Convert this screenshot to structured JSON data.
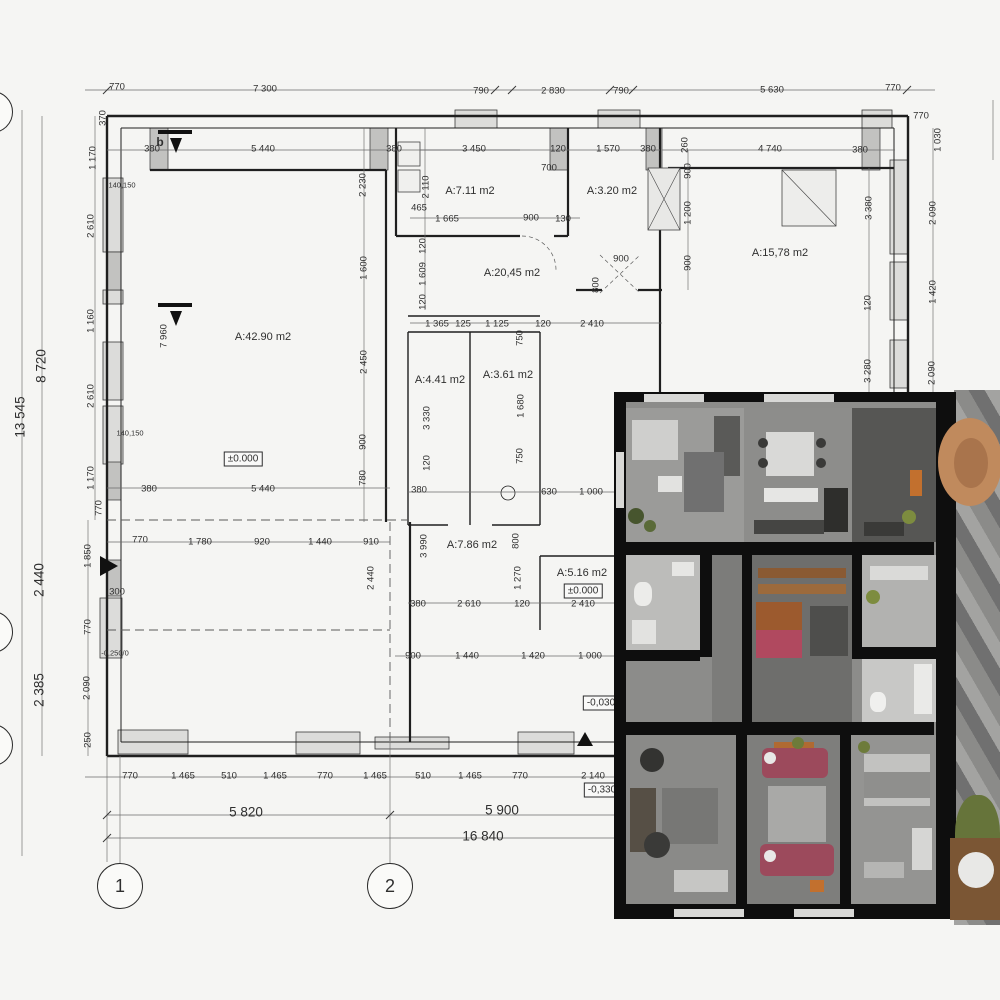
{
  "plan": {
    "section_label": "b",
    "room_labels": [
      {
        "t": "A:7.11 m2",
        "x": 470,
        "y": 191
      },
      {
        "t": "A:3.20 m2",
        "x": 612,
        "y": 191
      },
      {
        "t": "A:15,78 m2",
        "x": 780,
        "y": 253
      },
      {
        "t": "A:20,45 m2",
        "x": 512,
        "y": 273
      },
      {
        "t": "A:42.90 m2",
        "x": 263,
        "y": 337
      },
      {
        "t": "A:4.41 m2",
        "x": 440,
        "y": 380
      },
      {
        "t": "A:3.61 m2",
        "x": 508,
        "y": 375
      },
      {
        "t": "A:7.86 m2",
        "x": 472,
        "y": 545
      },
      {
        "t": "A:5.16 m2",
        "x": 582,
        "y": 573
      }
    ],
    "level_labels": [
      {
        "t": "±0.000",
        "x": 243,
        "y": 459
      },
      {
        "t": "±0.000",
        "x": 583,
        "y": 591
      },
      {
        "t": "-0,030",
        "x": 601,
        "y": 703
      },
      {
        "t": "-0,330",
        "x": 602,
        "y": 790
      }
    ],
    "small_labels": [
      {
        "t": "-0,250/0",
        "x": 115,
        "y": 653
      },
      {
        "t": "140,150",
        "x": 130,
        "y": 433
      },
      {
        "t": "140,150",
        "x": 122,
        "y": 185
      }
    ],
    "axis_bubbles": [
      {
        "n": "1",
        "x": 120,
        "y": 886
      },
      {
        "n": "2",
        "x": 390,
        "y": 886
      }
    ],
    "edge_bubbles": [
      {
        "x": -8,
        "y": 112
      },
      {
        "x": -8,
        "y": 632
      },
      {
        "x": -8,
        "y": 745
      }
    ],
    "dim_labels": [
      {
        "t": "770",
        "x": 117,
        "y": 87
      },
      {
        "t": "7 300",
        "x": 265,
        "y": 89
      },
      {
        "t": "790",
        "x": 481,
        "y": 91
      },
      {
        "t": "2 830",
        "x": 553,
        "y": 91
      },
      {
        "t": "790",
        "x": 621,
        "y": 91
      },
      {
        "t": "5 630",
        "x": 772,
        "y": 90
      },
      {
        "t": "770",
        "x": 893,
        "y": 88
      },
      {
        "t": "770",
        "x": 921,
        "y": 116
      },
      {
        "t": "1 030",
        "x": 938,
        "y": 140,
        "r": 90
      },
      {
        "t": "370",
        "x": 103,
        "y": 118,
        "r": 90
      },
      {
        "t": "380",
        "x": 152,
        "y": 149
      },
      {
        "t": "5 440",
        "x": 263,
        "y": 149
      },
      {
        "t": "380",
        "x": 394,
        "y": 149
      },
      {
        "t": "3 450",
        "x": 474,
        "y": 149
      },
      {
        "t": "120",
        "x": 558,
        "y": 149
      },
      {
        "t": "1 570",
        "x": 608,
        "y": 149
      },
      {
        "t": "380",
        "x": 648,
        "y": 149
      },
      {
        "t": "700",
        "x": 549,
        "y": 168
      },
      {
        "t": "260",
        "x": 685,
        "y": 145,
        "r": 90
      },
      {
        "t": "4 740",
        "x": 770,
        "y": 149
      },
      {
        "t": "380",
        "x": 860,
        "y": 150
      },
      {
        "t": "1 170",
        "x": 93,
        "y": 158,
        "r": 90
      },
      {
        "t": "2 610",
        "x": 91,
        "y": 226,
        "r": 90
      },
      {
        "t": "1 160",
        "x": 91,
        "y": 321,
        "r": 90
      },
      {
        "t": "2 610",
        "x": 91,
        "y": 396,
        "r": 90
      },
      {
        "t": "1 170",
        "x": 91,
        "y": 478,
        "r": 90
      },
      {
        "t": "770",
        "x": 99,
        "y": 508,
        "r": 90
      },
      {
        "t": "13 545",
        "x": 20,
        "y": 417,
        "r": 90,
        "big": 1
      },
      {
        "t": "8 720",
        "x": 41,
        "y": 366,
        "r": 90,
        "big": 1
      },
      {
        "t": "2 440",
        "x": 39,
        "y": 580,
        "r": 90,
        "big": 1
      },
      {
        "t": "2 385",
        "x": 39,
        "y": 690,
        "r": 90,
        "big": 1
      },
      {
        "t": "1 850",
        "x": 88,
        "y": 556,
        "r": 90
      },
      {
        "t": "770",
        "x": 88,
        "y": 627,
        "r": 90
      },
      {
        "t": "2 090",
        "x": 87,
        "y": 688,
        "r": 90
      },
      {
        "t": "250",
        "x": 88,
        "y": 740,
        "r": 90
      },
      {
        "t": "300",
        "x": 117,
        "y": 592
      },
      {
        "t": "770",
        "x": 140,
        "y": 540
      },
      {
        "t": "7 960",
        "x": 164,
        "y": 336,
        "r": 90
      },
      {
        "t": "2 230",
        "x": 363,
        "y": 185,
        "r": 90
      },
      {
        "t": "1 600",
        "x": 364,
        "y": 268,
        "r": 90
      },
      {
        "t": "2 450",
        "x": 364,
        "y": 362,
        "r": 90
      },
      {
        "t": "900",
        "x": 363,
        "y": 442,
        "r": 90
      },
      {
        "t": "780",
        "x": 363,
        "y": 478,
        "r": 90
      },
      {
        "t": "2 110",
        "x": 426,
        "y": 187,
        "r": 90
      },
      {
        "t": "465",
        "x": 419,
        "y": 208
      },
      {
        "t": "120",
        "x": 423,
        "y": 246,
        "r": 90
      },
      {
        "t": "1 609",
        "x": 423,
        "y": 274,
        "r": 90
      },
      {
        "t": "120",
        "x": 423,
        "y": 302,
        "r": 90
      },
      {
        "t": "1 665",
        "x": 447,
        "y": 219
      },
      {
        "t": "900",
        "x": 531,
        "y": 218
      },
      {
        "t": "130",
        "x": 563,
        "y": 219
      },
      {
        "t": "900",
        "x": 688,
        "y": 171,
        "r": 90
      },
      {
        "t": "1 200",
        "x": 688,
        "y": 213,
        "r": 90
      },
      {
        "t": "900",
        "x": 688,
        "y": 263,
        "r": 90
      },
      {
        "t": "1 365",
        "x": 437,
        "y": 324
      },
      {
        "t": "125",
        "x": 463,
        "y": 324
      },
      {
        "t": "1 125",
        "x": 497,
        "y": 324
      },
      {
        "t": "120",
        "x": 543,
        "y": 324
      },
      {
        "t": "2 410",
        "x": 592,
        "y": 324
      },
      {
        "t": "750",
        "x": 520,
        "y": 338,
        "r": 90
      },
      {
        "t": "1 680",
        "x": 521,
        "y": 406,
        "r": 90
      },
      {
        "t": "750",
        "x": 520,
        "y": 456,
        "r": 90
      },
      {
        "t": "3 330",
        "x": 427,
        "y": 418,
        "r": 90
      },
      {
        "t": "120",
        "x": 427,
        "y": 463,
        "r": 90
      },
      {
        "t": "900",
        "x": 621,
        "y": 259
      },
      {
        "t": "800",
        "x": 596,
        "y": 285,
        "r": 90
      },
      {
        "t": "380",
        "x": 149,
        "y": 489
      },
      {
        "t": "5 440",
        "x": 263,
        "y": 489
      },
      {
        "t": "380",
        "x": 419,
        "y": 490
      },
      {
        "t": "630",
        "x": 549,
        "y": 492
      },
      {
        "t": "1 000",
        "x": 591,
        "y": 492
      },
      {
        "t": "3 380",
        "x": 869,
        "y": 208,
        "r": 90
      },
      {
        "t": "120",
        "x": 868,
        "y": 303,
        "r": 90
      },
      {
        "t": "3 280",
        "x": 868,
        "y": 371,
        "r": 90
      },
      {
        "t": "2 090",
        "x": 933,
        "y": 213,
        "r": 90
      },
      {
        "t": "1 420",
        "x": 933,
        "y": 292,
        "r": 90
      },
      {
        "t": "2 090",
        "x": 932,
        "y": 373,
        "r": 90
      },
      {
        "t": "1 780",
        "x": 200,
        "y": 542
      },
      {
        "t": "920",
        "x": 262,
        "y": 542
      },
      {
        "t": "1 440",
        "x": 320,
        "y": 542
      },
      {
        "t": "910",
        "x": 371,
        "y": 542
      },
      {
        "t": "2 440",
        "x": 371,
        "y": 578,
        "r": 90
      },
      {
        "t": "3 990",
        "x": 424,
        "y": 546,
        "r": 90
      },
      {
        "t": "800",
        "x": 516,
        "y": 541,
        "r": 90
      },
      {
        "t": "1 270",
        "x": 518,
        "y": 578,
        "r": 90
      },
      {
        "t": "380",
        "x": 418,
        "y": 604
      },
      {
        "t": "2 610",
        "x": 469,
        "y": 604
      },
      {
        "t": "120",
        "x": 522,
        "y": 604
      },
      {
        "t": "2 410",
        "x": 583,
        "y": 604
      },
      {
        "t": "900",
        "x": 413,
        "y": 656
      },
      {
        "t": "1 440",
        "x": 467,
        "y": 656
      },
      {
        "t": "1 420",
        "x": 533,
        "y": 656
      },
      {
        "t": "1 000",
        "x": 590,
        "y": 656
      },
      {
        "t": "770",
        "x": 130,
        "y": 776
      },
      {
        "t": "1 465",
        "x": 183,
        "y": 776
      },
      {
        "t": "510",
        "x": 229,
        "y": 776
      },
      {
        "t": "1 465",
        "x": 275,
        "y": 776
      },
      {
        "t": "770",
        "x": 325,
        "y": 776
      },
      {
        "t": "1 465",
        "x": 375,
        "y": 776
      },
      {
        "t": "510",
        "x": 423,
        "y": 776
      },
      {
        "t": "1 465",
        "x": 470,
        "y": 776
      },
      {
        "t": "770",
        "x": 520,
        "y": 776
      },
      {
        "t": "2 140",
        "x": 593,
        "y": 776
      },
      {
        "t": "5 820",
        "x": 246,
        "y": 812,
        "big": 1
      },
      {
        "t": "5 900",
        "x": 502,
        "y": 810,
        "big": 1
      },
      {
        "t": "16 840",
        "x": 483,
        "y": 836,
        "big": 1
      }
    ],
    "colors": {
      "plan_bg": "#f5f5f3",
      "line": "#1f1f1f",
      "dim_text": "#2f2f2f",
      "wall_fill": "#d2d2d0",
      "render_wall": "#0e0e0e",
      "accent_red": "#9c4a5c",
      "accent_orange": "#c2702e",
      "accent_green": "#6d7b3a",
      "wood": "#8a5a33",
      "tan_chair": "#c08a5d"
    }
  }
}
